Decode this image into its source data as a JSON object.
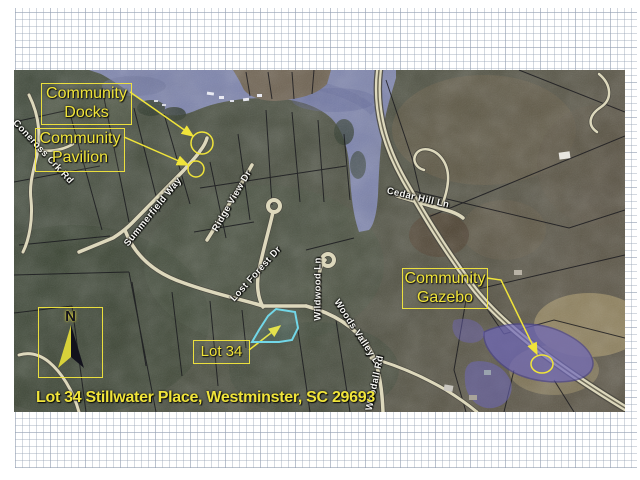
{
  "map": {
    "caption": "Lot 34 Stillwater Place, Westminster, SC 29693",
    "compass": {
      "label": "N"
    },
    "annotations": [
      {
        "id": "community-docks",
        "line1": "Community",
        "line2": "Docks"
      },
      {
        "id": "community-pavilion",
        "line1": "Community",
        "line2": "Pavilion"
      },
      {
        "id": "community-gazebo",
        "line1": "Community",
        "line2": "Gazebo"
      },
      {
        "id": "lot-34",
        "label": "Lot 34"
      }
    ],
    "road_labels": [
      "Summerfield Way",
      "Ridge View Dr",
      "Lost Forest Dr",
      "Wildwood Ln",
      "Woods Valley Dr",
      "Woodall Rd",
      "Cedar Hill Ln",
      "Coneross Crk Rd"
    ],
    "colors": {
      "annotation_yellow": "#f0e43a",
      "lot_outline_cyan": "#72d7e8",
      "lake_water": "#7d84ad",
      "pond_purple": "#6e67ba",
      "road_pale": "#ddd8bc"
    }
  }
}
